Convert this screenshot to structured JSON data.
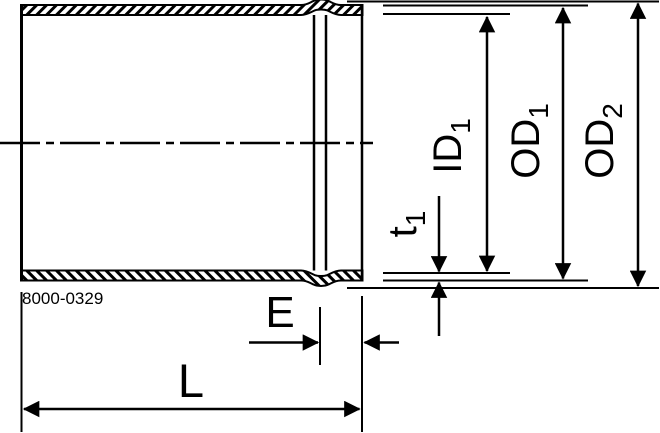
{
  "part_number": "8000-0329",
  "labels": {
    "id1": {
      "main": "ID",
      "sub": "1"
    },
    "od1": {
      "main": "OD",
      "sub": "1"
    },
    "od2": {
      "main": "OD",
      "sub": "2"
    },
    "t1": {
      "main": "t",
      "sub": "1"
    },
    "e": {
      "main": "E"
    },
    "l": {
      "main": "L"
    }
  },
  "colors": {
    "ink": "#000000",
    "paper": "#ffffff"
  }
}
